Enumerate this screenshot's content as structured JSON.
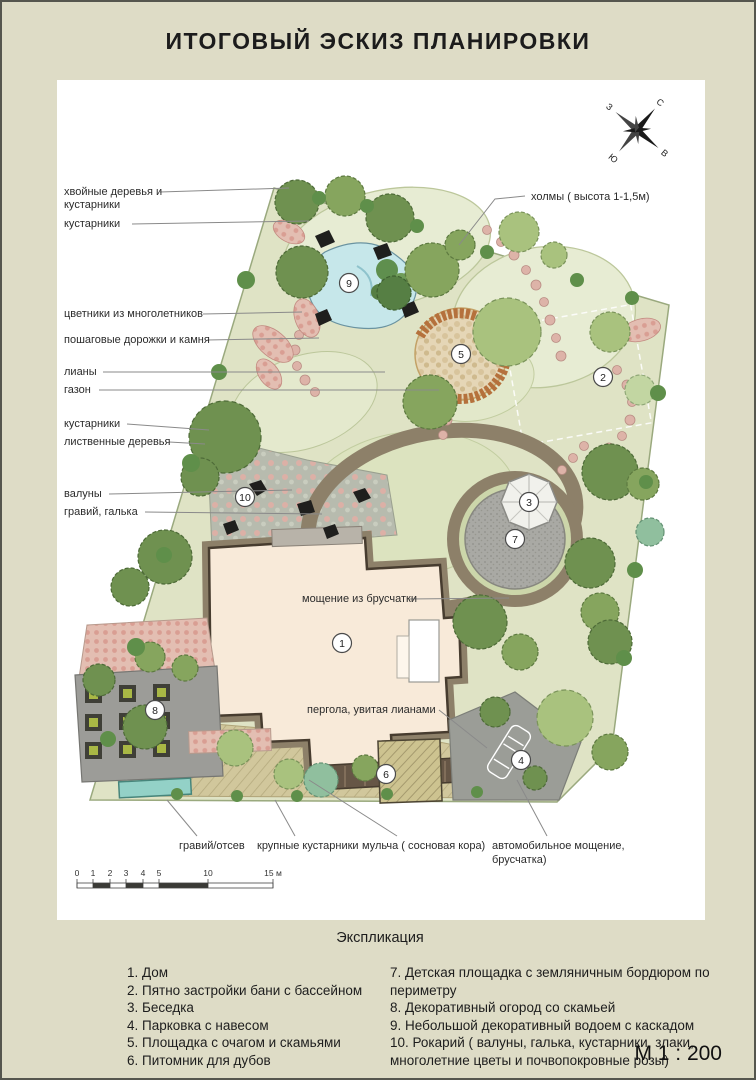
{
  "title": "ИТОГОВЫЙ ЭСКИЗ ПЛАНИРОВКИ",
  "compass": {
    "north": "С",
    "south": "Ю",
    "east": "В",
    "west": "З"
  },
  "plan": {
    "labels": {
      "conifers_line1": "хвойные деревья и",
      "conifers_line2": "кустарники",
      "shrubs_top": "кустарники",
      "perennials": "цветники из многолетников",
      "stepping_paths": "пошаговые дорожки и камня",
      "lianas": "лианы",
      "lawn": "газон",
      "shrubs_mid": "кустарники",
      "deciduous": "лиственные деревья",
      "boulders": "валуны",
      "gravel_pebbles": "гравий, галька",
      "hills": "холмы  ( высота 1-1,5м)",
      "paving": "мощение из брусчатки",
      "pergola": "пергола, увитая лианами",
      "gravel_siftings": "гравий/отсев",
      "large_shrubs": "крупные кустарники",
      "mulch": "мульча  ( сосновая кора)",
      "car_paving_line1": "автомобильное мощение,",
      "car_paving_line2": "брусчатка)"
    },
    "markers": [
      "1",
      "2",
      "3",
      "4",
      "5",
      "6",
      "7",
      "8",
      "9",
      "10"
    ],
    "scalebar_ticks": [
      "0",
      "1",
      "2",
      "3",
      "4",
      "5",
      "10",
      "15 м"
    ]
  },
  "legend": {
    "heading": "Экспликация",
    "left": [
      "1. Дом",
      "2. Пятно застройки бани с бассейном",
      "3. Беседка",
      "4. Парковка с навесом",
      "5. Площадка с очагом и скамьями",
      "6. Питомник для дубов"
    ],
    "right": [
      "7. Детская площадка с земляничным бордюром по периметру",
      "8. Декоративный огород со скамьей",
      "9. Небольшой декоративный водоем с каскадом",
      "10. Рокарий  ( валуны, галька, кустарники, злаки, многолетние цветы и почвопокровные розы)"
    ]
  },
  "scale_note": "М 1 : 200",
  "colors": {
    "background": "#dedcc6",
    "paper": "#ffffff",
    "site_green": "#dfe3c5",
    "path_brown": "#8d8069",
    "water_blue": "#c6e7ea",
    "flower_pink": "#e2a79e",
    "house_cream": "#f8ead9"
  }
}
